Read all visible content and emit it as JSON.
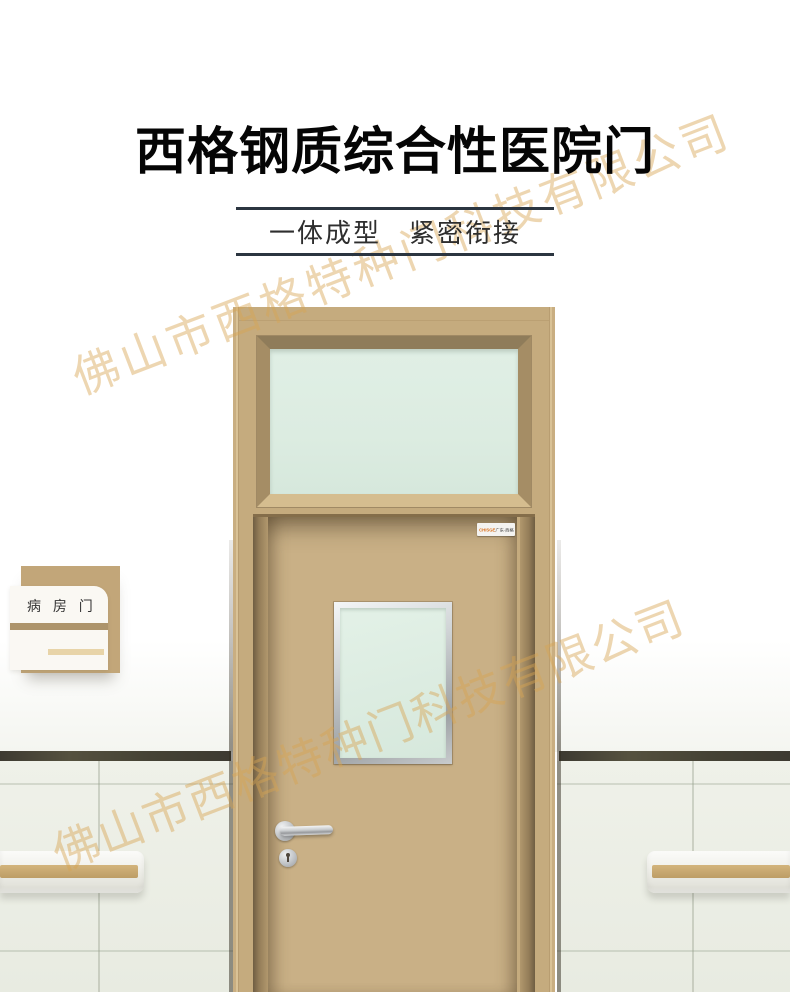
{
  "header": {
    "title": "西格钢质综合性医院门",
    "subtitle": "一体成型　紧密衔接"
  },
  "watermark": {
    "text": "佛山市西格特种门科技有限公司",
    "color": "#e9c077"
  },
  "door_sign": {
    "label": "病 房 门"
  },
  "door": {
    "brand_plate": {
      "logo": "CHISGE",
      "region": "广东·西格",
      "subtext": "·······"
    }
  },
  "colors": {
    "title_text": "#050505",
    "subtitle_rule": "#2b3540",
    "door_frame": "#c5ab7e",
    "door_leaf": "#c9b086",
    "transom_bevel_dark": "#8f7c5a",
    "transom_bevel_light": "#d5bd8f",
    "glass": "#dcece1",
    "stainless": "#c9ccce",
    "sign_tan": "#c2a679",
    "sign_stripe_dark": "#ad946b",
    "sign_stripe_light": "#e8d4a8",
    "wall_tile": "#edefe7",
    "trim_band": "#45423a",
    "handrail_stripe": "#c9a96f"
  }
}
